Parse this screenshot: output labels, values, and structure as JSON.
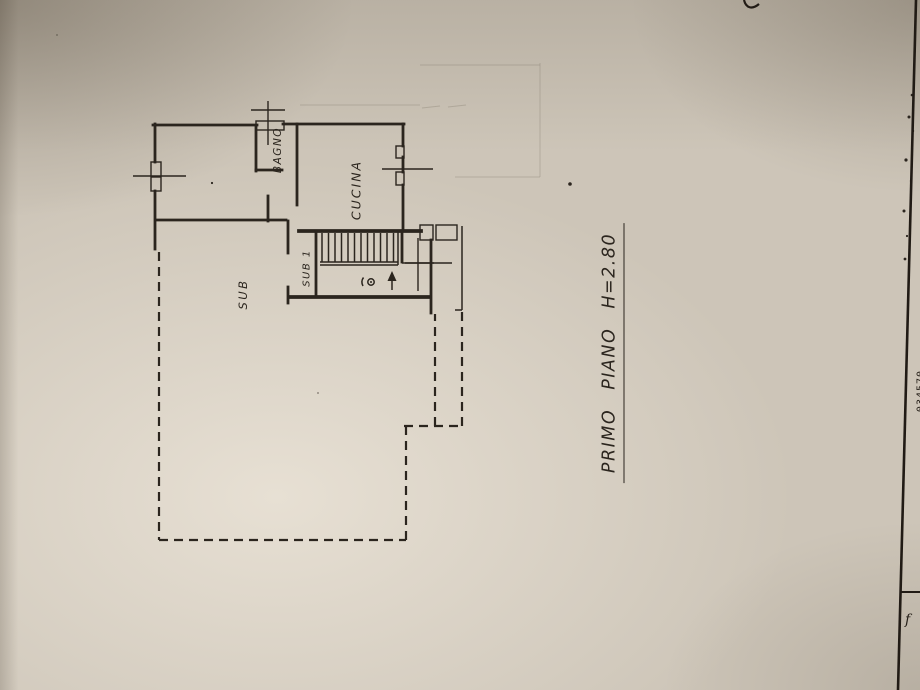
{
  "plan": {
    "labels": {
      "bagno": "BAGNO",
      "cucina": "CUCINA",
      "sub": "SUB",
      "sub1": "SUB 1"
    },
    "caption": "PRIMO PIANO H=2.80"
  },
  "sheet_edge": {
    "numbers": "034570",
    "mark": "f"
  },
  "colors": {
    "paper-base": "#cdc5b8",
    "paper-light": "#ded7ca",
    "ink": "#2b251e",
    "ink-faint": "#8a8174"
  }
}
